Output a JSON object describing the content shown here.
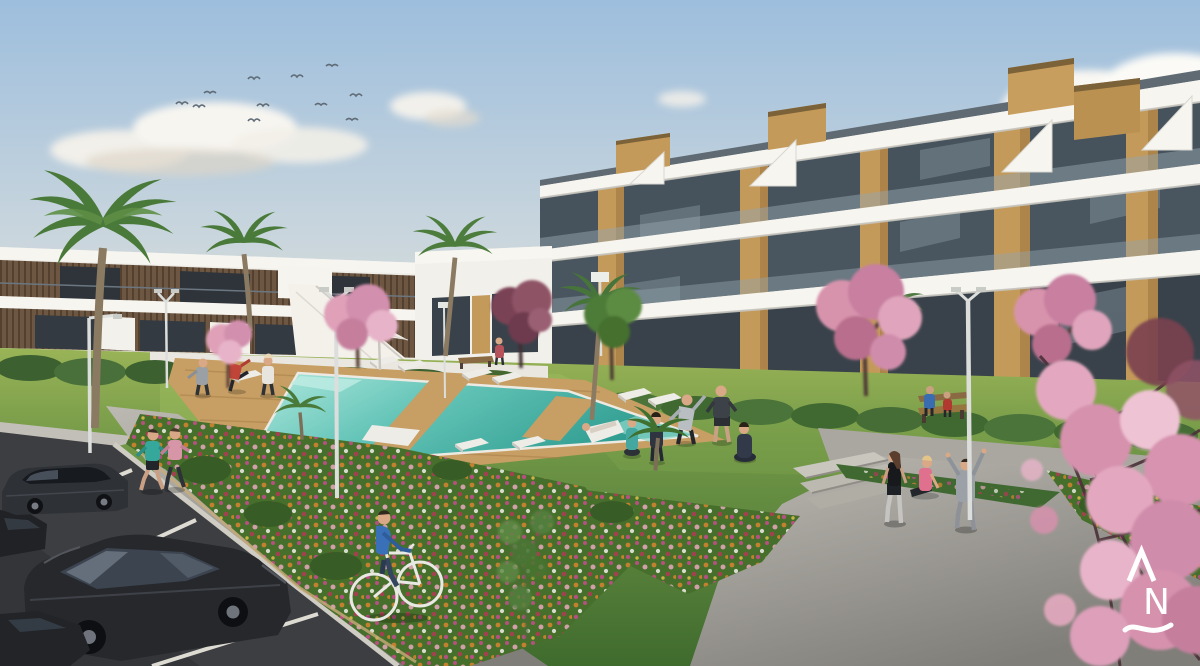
{
  "scene": {
    "kind": "3d-architectural-render",
    "subject": "white residential apartment complex with communal pool garden, flower beds, parking lot and cherry-blossom trees",
    "sky": {
      "birds": 11,
      "cloud_groups": 5
    },
    "buildings": {
      "right": {
        "floors": 3,
        "style": "white slab bands, glass balconies, vertical wood panels, rooftop wood boxes"
      },
      "left": {
        "floors": 2,
        "style": "white slabs with dark wood slat cladding and external white staircase"
      }
    },
    "pool": {
      "loungers": 9,
      "parasols": 1,
      "deck": "wood with crossing walkways"
    },
    "vehicles": {
      "cars": 4,
      "bicycles": 1
    },
    "people_count": 18,
    "people_activities": [
      "jogging",
      "cycling",
      "stretching on pool deck",
      "yoga on lawn",
      "sitting on deckchair",
      "sitting on bench",
      "stretching on plaza"
    ],
    "furniture": {
      "benches": 2,
      "lampposts": 6
    },
    "flora": {
      "palms": 7,
      "blossom_trees": 5,
      "flower_beds": 4
    }
  },
  "palette": {
    "sky_top": "#9dbedd",
    "sky_mid": "#c6d4dd",
    "horizon": "#ded0c8",
    "cloud_white": "#f7f5f0",
    "cloud_shadow": "#d3ccc1",
    "building_white": "#f4f2ec",
    "building_shadow": "#d9d7d0",
    "glass_dark": "#46525c",
    "glass_darker": "#39424a",
    "wood": "#c49a5a",
    "wood_dark": "#a87e45",
    "wood_slat": "#6e5742",
    "grass_light": "#97b258",
    "grass_dark": "#446f30",
    "bed_green": "#466f2c",
    "pool_light": "#aee7dd",
    "pool_deep": "#2f9c90",
    "deck_wood": "#c79e63",
    "path_gray": "#a5a29b",
    "plaza_gray": "#aaa7a0",
    "step_gray": "#c0bdb5",
    "asphalt": "#3d3e42",
    "curb": "#cfccc4",
    "line_white": "#dedbd2",
    "car_black": "#26282c",
    "car_gray": "#2e3136",
    "blossom_pink": "#dfa0b8",
    "blossom_deep": "#c57f9d",
    "maroon_tree": "#7a4355",
    "lamp_white": "#dcdedb",
    "bird_gray": "#5f6b76",
    "logo_white": "#ffffff"
  },
  "logo": {
    "letter": "N",
    "mark": "caret above N above wave",
    "color": "#ffffff"
  }
}
